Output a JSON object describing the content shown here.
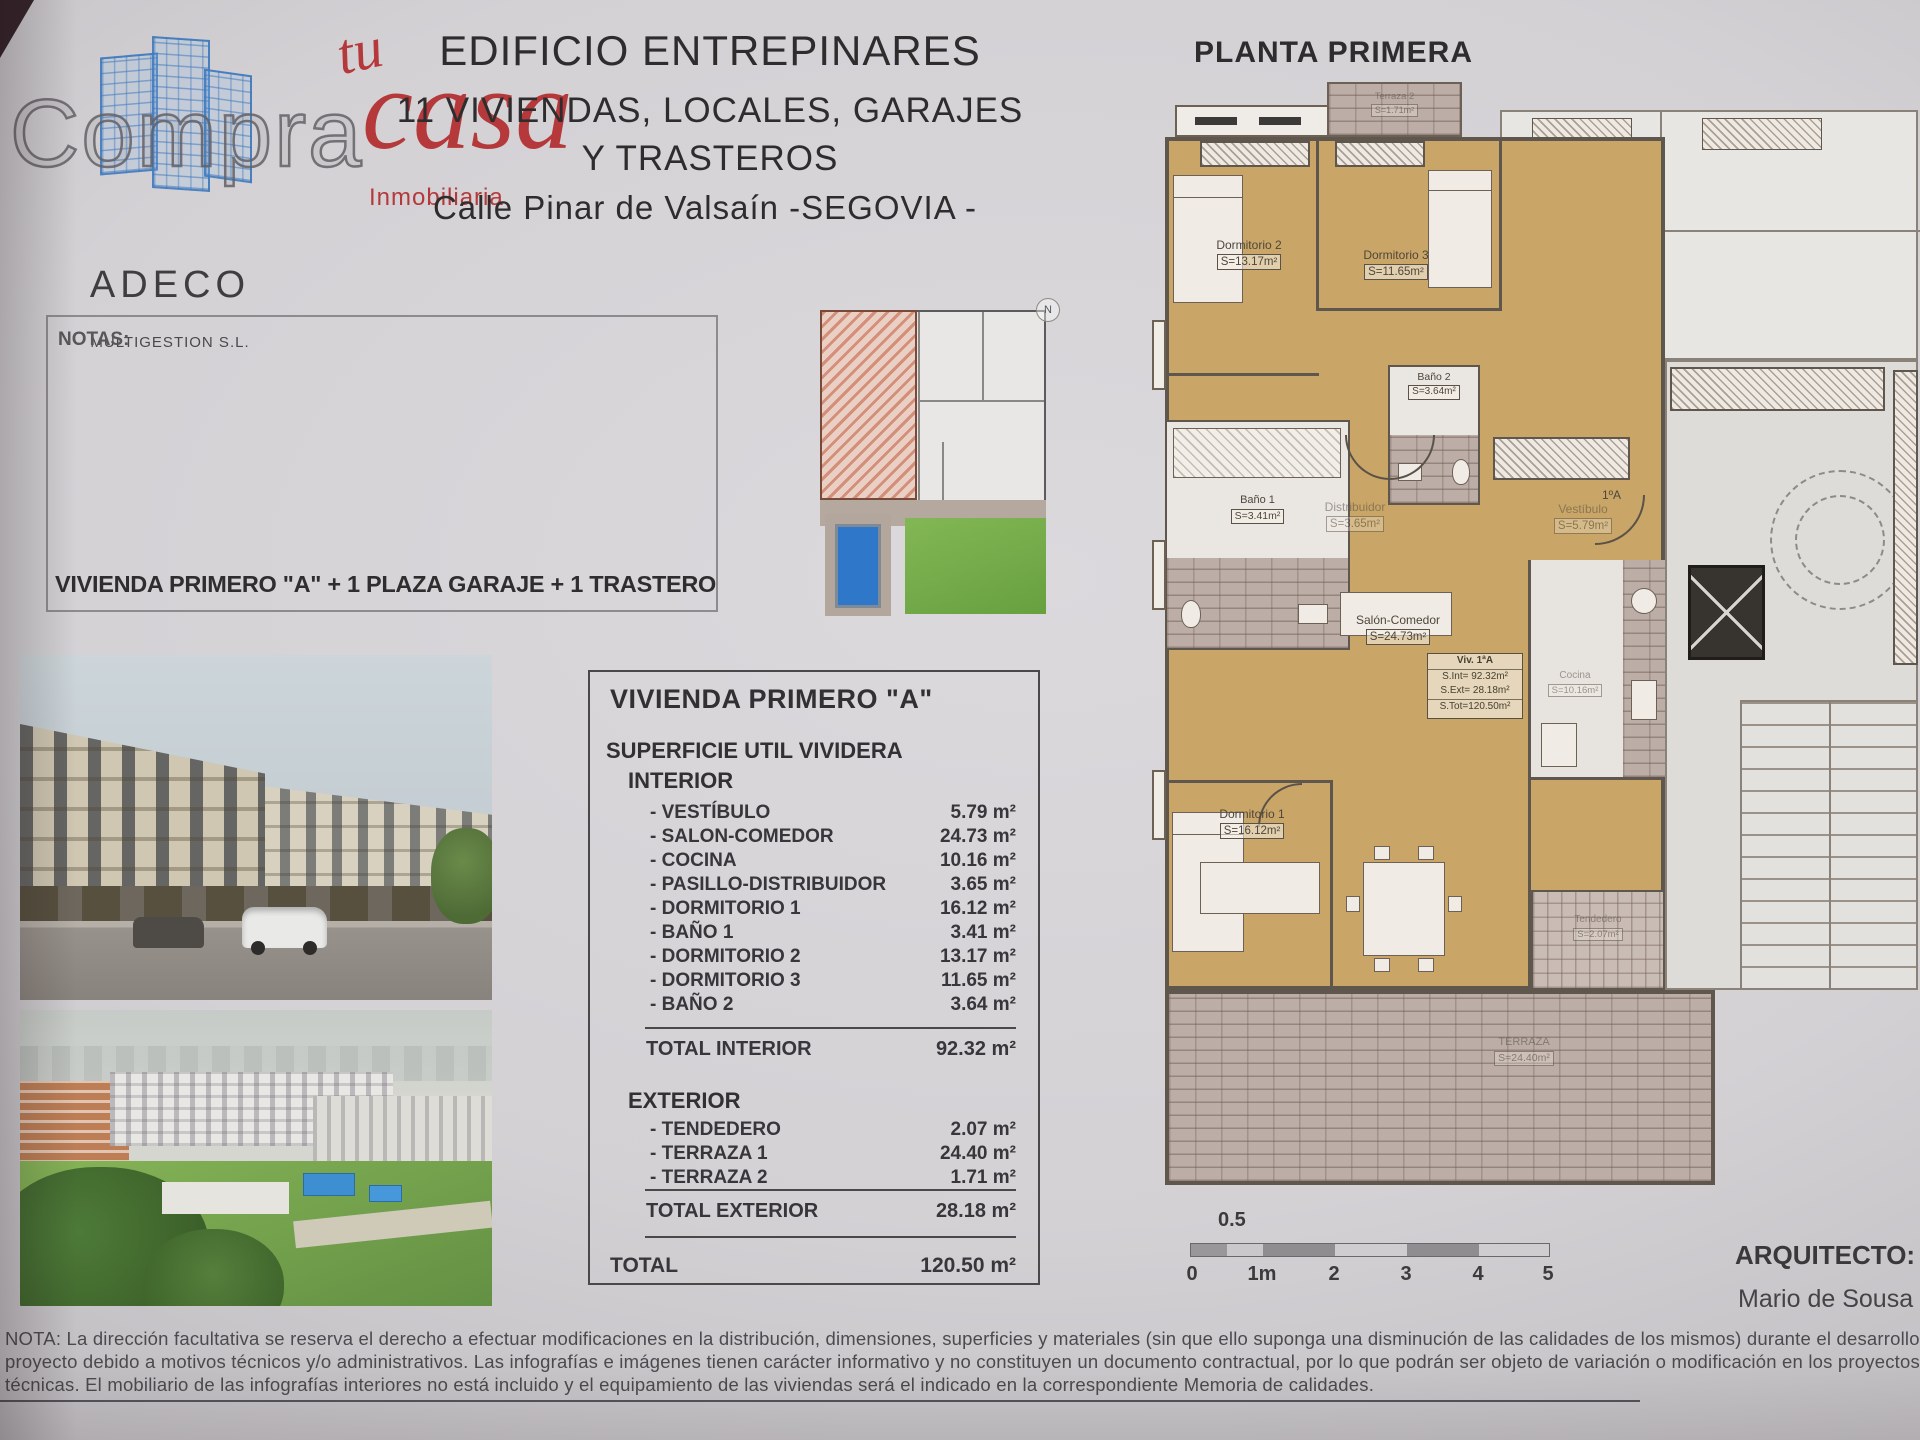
{
  "branding": {
    "compra": "Compra",
    "tu": "tu",
    "casa": "casa",
    "inmobiliaria": "Inmobiliaria",
    "adeco": "ADECO",
    "multigestion": "MULTIGESTION S.L."
  },
  "header": {
    "title": "EDIFICIO ENTREPINARES",
    "subtitle1": "11 VIVIENDAS, LOCALES, GARAJES",
    "subtitle2": "Y TRASTEROS",
    "address": "Calle Pinar de Valsaín -SEGOVIA -",
    "plan_title": "PLANTA PRIMERA"
  },
  "notas_label": "NOTAS:",
  "unit_line": "VIVIENDA PRIMERO \"A\"  +  1 PLAZA GARAJE  +  1 TRASTERO",
  "surface_table": {
    "title": "VIVIENDA PRIMERO \"A\"",
    "subtitle": "SUPERFICIE UTIL VIVIDERA",
    "interior_label": "INTERIOR",
    "interior_rows": [
      {
        "label": "- VESTÍBULO",
        "value": "5.79 m²"
      },
      {
        "label": "- SALON-COMEDOR",
        "value": "24.73 m²"
      },
      {
        "label": "- COCINA",
        "value": "10.16 m²"
      },
      {
        "label": "- PASILLO-DISTRIBUIDOR",
        "value": "3.65 m²"
      },
      {
        "label": "- DORMITORIO 1",
        "value": "16.12 m²"
      },
      {
        "label": "- BAÑO 1",
        "value": "3.41 m²"
      },
      {
        "label": "- DORMITORIO 2",
        "value": "13.17 m²"
      },
      {
        "label": "- DORMITORIO 3",
        "value": "11.65 m²"
      },
      {
        "label": "- BAÑO 2",
        "value": "3.64 m²"
      }
    ],
    "total_interior": {
      "label": "TOTAL INTERIOR",
      "value": "92.32 m²"
    },
    "exterior_label": "EXTERIOR",
    "exterior_rows": [
      {
        "label": "- TENDEDERO",
        "value": "2.07 m²"
      },
      {
        "label": "- TERRAZA 1",
        "value": "24.40 m²"
      },
      {
        "label": "- TERRAZA 2",
        "value": "1.71 m²"
      }
    ],
    "total_exterior": {
      "label": "TOTAL EXTERIOR",
      "value": "28.18 m²"
    },
    "total": {
      "label": "TOTAL",
      "value": "120.50 m²"
    }
  },
  "plan": {
    "rooms": [
      {
        "name": "Terraza 2",
        "area": "S=1.71m²"
      },
      {
        "name": "Dormitorio 2",
        "area": "S=13.17m²"
      },
      {
        "name": "Dormitorio 3",
        "area": "S=11.65m²"
      },
      {
        "name": "Baño 2",
        "area": "S=3.64m²"
      },
      {
        "name": "Baño 1",
        "area": "S=3.41m²"
      },
      {
        "name": "Distribuidor",
        "area": "S=3.65m²"
      },
      {
        "name": "Vestíbulo",
        "area": "S=5.79m²"
      },
      {
        "name": "Salón-Comedor",
        "area": "S=24.73m²"
      },
      {
        "name": "Dormitorio 1",
        "area": "S=16.12m²"
      },
      {
        "name": "Cocina",
        "area": "S=10.16m²"
      },
      {
        "name": "Tendedero",
        "area": "S=2.07m²"
      },
      {
        "name": "TERRAZA",
        "area": "S=24.40m²"
      }
    ],
    "info_box": {
      "line1": "Viv. 1ªA",
      "line2": "S.Int= 92.32m²",
      "line3": "S.Ext= 28.18m²",
      "line4": "S.Tot=120.50m²"
    },
    "door_label": "1ºA",
    "compass": "N"
  },
  "scale_bar": {
    "top_label": "0.5",
    "ticks": [
      "0",
      "1m",
      "2",
      "3",
      "4",
      "5"
    ]
  },
  "architect": {
    "label": "ARQUITECTO:",
    "name": "Mario de Sousa Sanch"
  },
  "disclaimer": {
    "line1": "NOTA:  La dirección facultativa se reserva el derecho a efectuar modificaciones en la distribución, dimensiones, superficies y materiales (sin que ello suponga una disminución de las calidades de los mismos) durante el desarrollo del",
    "line2": "proyecto debido a motivos técnicos y/o administrativos. Las infografías e imágenes tienen carácter informativo y no constituyen un documento contractual, por lo que podrán ser objeto de variación o modificación en los proyectos",
    "line3": "técnicas. El mobiliario de las infografías interiores no está incluido y el equipamiento de las viviendas será el indicado en la correspondiente Memoria de calidades."
  }
}
